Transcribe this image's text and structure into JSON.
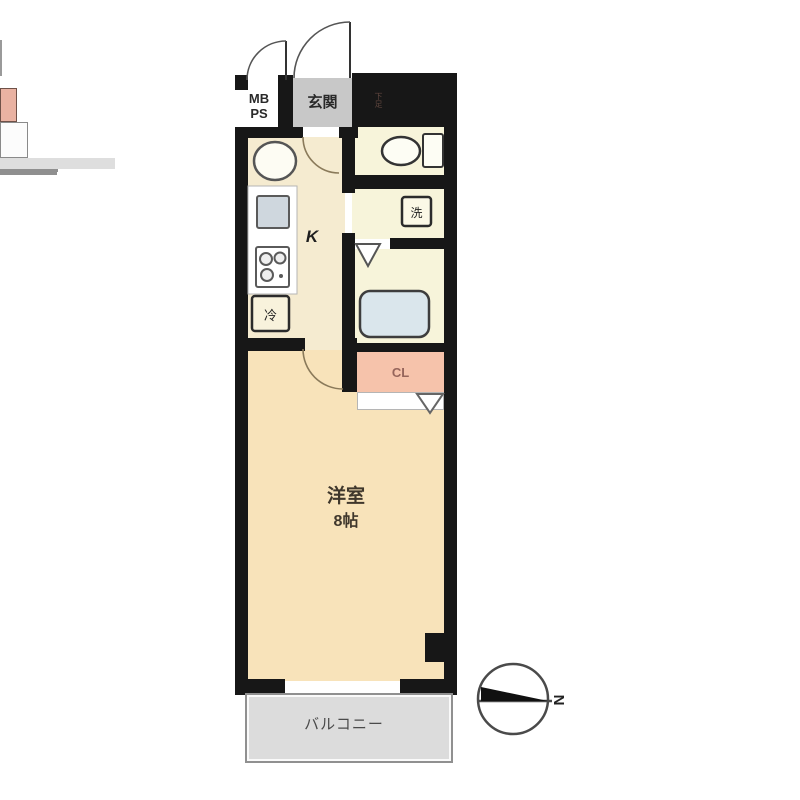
{
  "floorplan": {
    "mbps": "MB\nPS",
    "entrance": "玄関",
    "shoe_box": "下足",
    "kitchen": "K",
    "refrigerator": "冷",
    "washer": "洗",
    "closet": "CL",
    "main_room_name": "洋室",
    "main_room_size": "8帖",
    "balcony": "バルコニー",
    "compass_north": "N"
  },
  "colors": {
    "wall": "#171717",
    "kitchen_floor": "#f5ebd0",
    "main_room_floor": "#f8e3ba",
    "wet_area_floor": "#f7f4da",
    "closet_fill": "#f6c3ab",
    "entrance_floor": "#c8c8c8",
    "balcony_fill": "#dcdcdc",
    "bathtub_fill": "#dae6ec",
    "shoe_box_fill": "#e9b2a2",
    "sink_square_fill": "#cfd7de"
  }
}
